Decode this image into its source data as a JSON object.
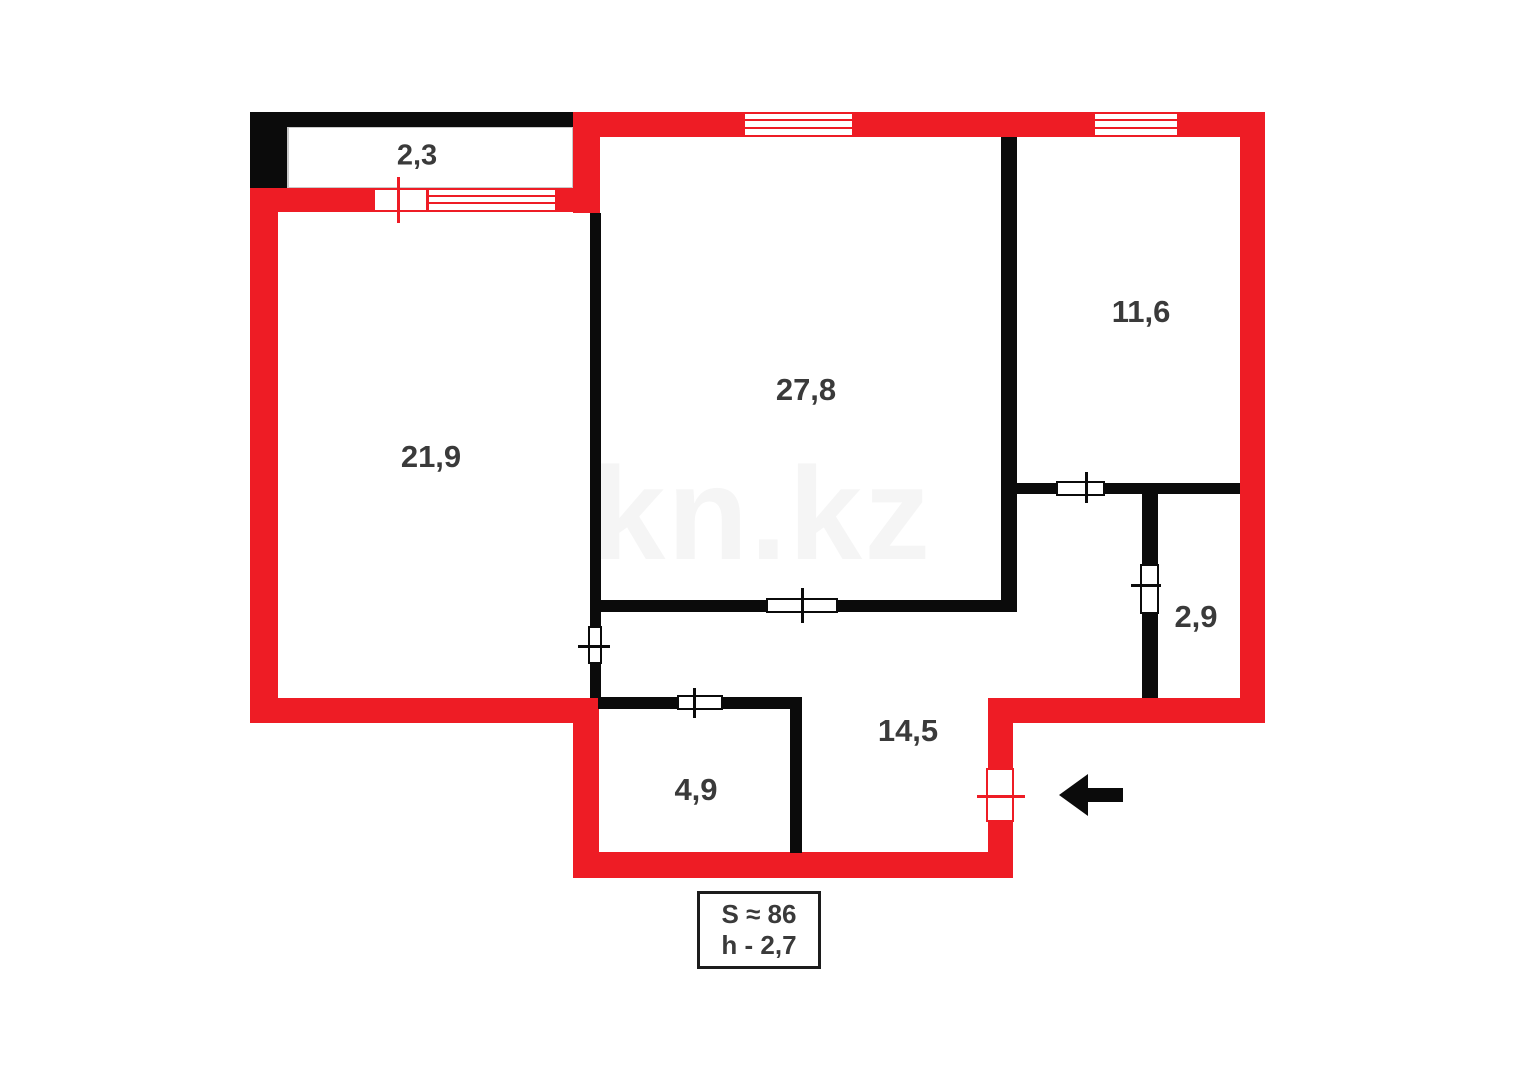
{
  "watermark": "kn.kz",
  "info_box": {
    "area": "S ≈ 86",
    "ceiling_height": "h - 2,7"
  },
  "rooms": {
    "balcony": "2,3",
    "living_room": "21,9",
    "main_room": "27,8",
    "bedroom": "11,6",
    "closet": "2,9",
    "hallway": "14,5",
    "kitchen": "4,9"
  },
  "colors": {
    "exterior_wall": "#ee1c25",
    "interior_wall": "#0b0b0b",
    "label_text": "#3a3a3a",
    "watermark_text": "#f5f5f5"
  }
}
